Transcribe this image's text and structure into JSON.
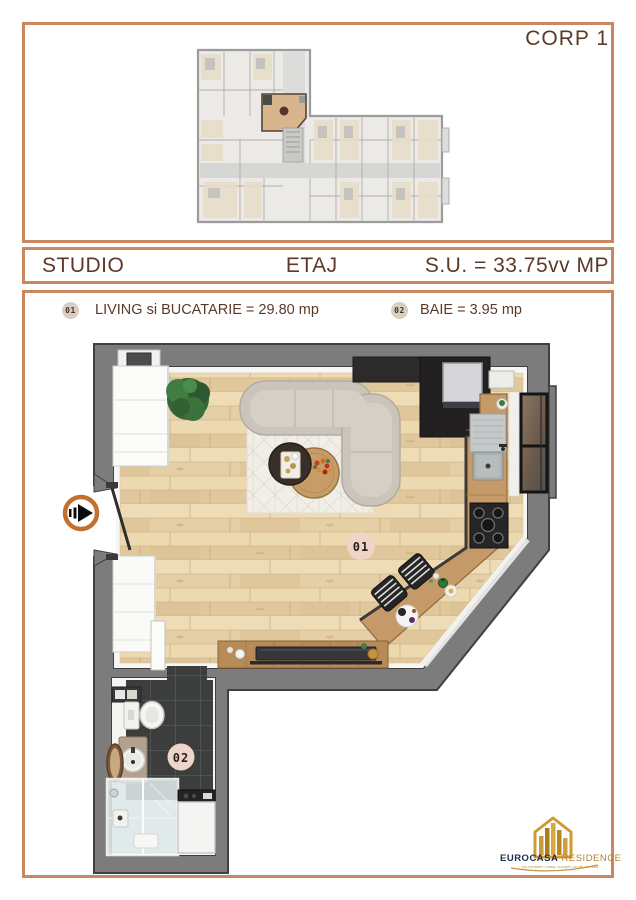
{
  "frame": {
    "corp_label": "CORP 1"
  },
  "band": {
    "left": "STUDIO",
    "center": "ETAJ",
    "right": "S.U. = 33.75vv MP"
  },
  "legend": {
    "items": [
      {
        "badge": "01",
        "label": "LIVING si BUCATARIE = 29.80 mp"
      },
      {
        "badge": "02",
        "label": "BAIE = 3.95 mp"
      }
    ]
  },
  "plan": {
    "badges": [
      {
        "id": "01",
        "room": "living-kitchen"
      },
      {
        "id": "02",
        "room": "bathroom"
      }
    ]
  },
  "logo": {
    "brand": "EUROCASA",
    "suffix": "RESIDENCE",
    "tagline": "Nu cumperi o casa, cumperi un stil de viata"
  },
  "colors": {
    "frame": "#c9875f",
    "heading": "#5b3a28",
    "legend_badge_bg": "#d9cec2",
    "plan_badge_bg": "#eed5c8",
    "arrow_ring": "#c2702e",
    "wall_gray": "#7c7c7c",
    "wood_floor": "#ead7b1",
    "tile_dark": "#3c3e3e",
    "logo_navy": "#1c2d52",
    "logo_gold": "#b08433"
  }
}
